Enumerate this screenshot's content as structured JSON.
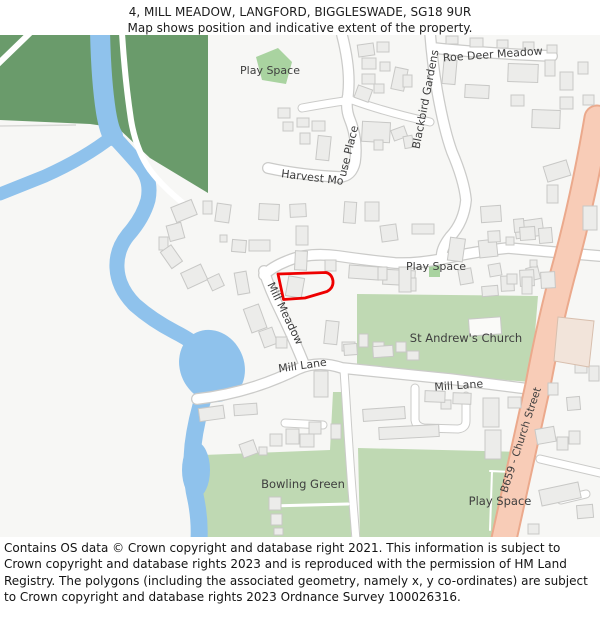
{
  "header": {
    "title": "4, MILL MEADOW, LANGFORD, BIGGLESWADE, SG18 9UR",
    "subtitle": "Map shows position and indicative extent of the property."
  },
  "map": {
    "labels": {
      "play_space_top": "Play Space",
      "roe_deer_meadow": "Roe Deer Meadow",
      "blackbird_gardens": "Blackbird Gardens",
      "harvest_mouse_place_part1": "Harvest Mo",
      "harvest_mouse_place_part2": "use Place",
      "play_space_mid": "Play Space",
      "mill_meadow": "Mill Meadow",
      "mill_lane_west": "Mill Lane",
      "st_andrews_church": "St Andrew's Church",
      "mill_lane_east": "Mill Lane",
      "bowling_green": "Bowling Green",
      "play_space_bottom": "Play Space",
      "b659_church_street": "B659 - Church Street"
    },
    "colors": {
      "property_outline": "#ee0000",
      "field_dark_green": "#6a9b6b",
      "parkland_green": "#bfd9b3",
      "play_space_green": "#a9d3a0",
      "water_blue": "#8fc2ec",
      "road_primary_fill": "#f8ccb7",
      "road_primary_casing": "#eba98c",
      "road_casing": "#cbcbc9",
      "building_fill": "#ececea",
      "building_stroke": "#c8c8c6",
      "special_building_fill": "#f2e4da",
      "label_text": "#3e3e3e"
    }
  },
  "footer": {
    "attribution": "Contains OS data © Crown copyright and database right 2021. This information is subject to Crown copyright and database rights 2023 and is reproduced with the permission of HM Land Registry. The polygons (including the associated geometry, namely x, y co-ordinates) are subject to Crown copyright and database rights 2023 Ordnance Survey 100026316."
  }
}
